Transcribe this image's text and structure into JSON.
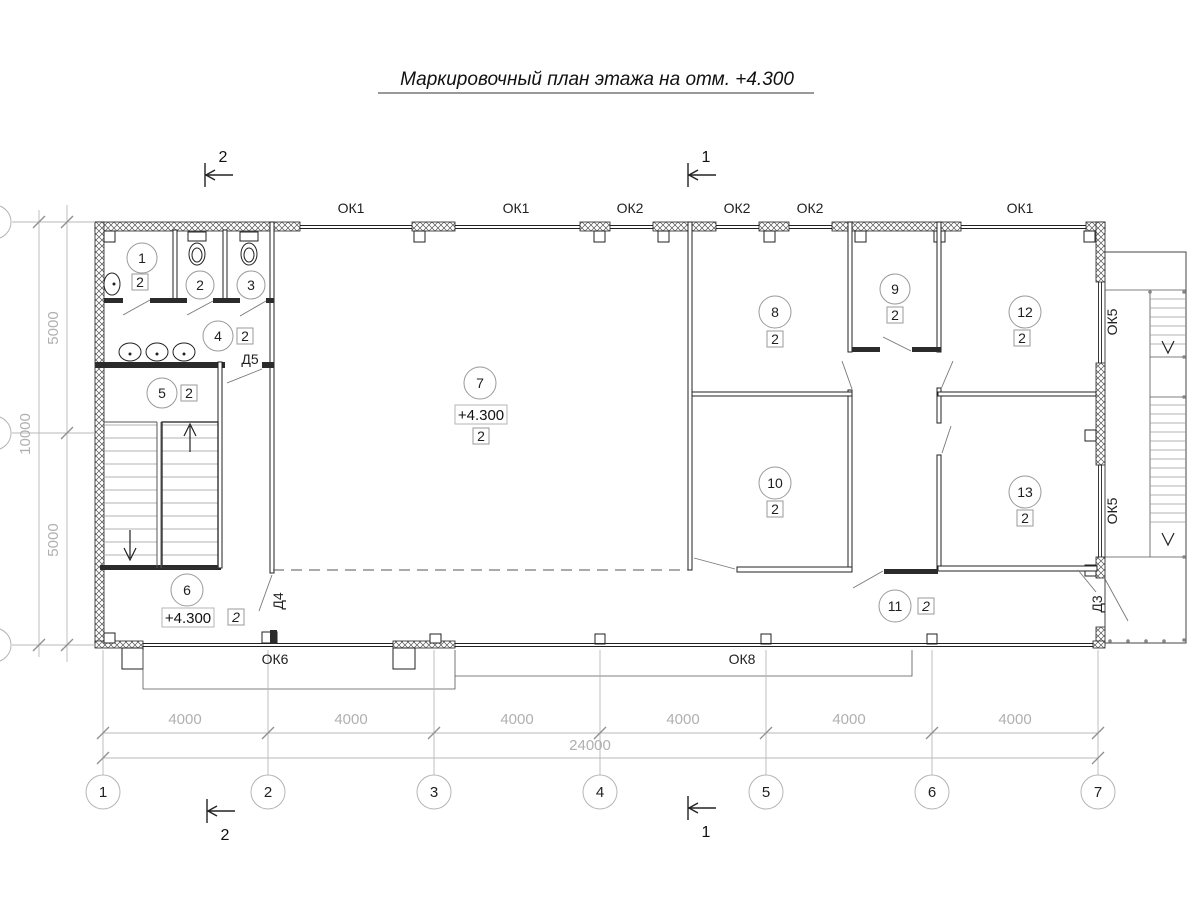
{
  "title": {
    "text": "Маркировочный план этажа на отм. +4.300"
  },
  "sections": {
    "top_left": "2",
    "top_center": "1",
    "bottom_left": "2",
    "bottom_center": "1"
  },
  "rooms": [
    {
      "number": "1",
      "qty": "2"
    },
    {
      "number": "2"
    },
    {
      "number": "3"
    },
    {
      "number": "4",
      "qty": "2"
    },
    {
      "number": "5",
      "qty": "2"
    },
    {
      "number": "6",
      "qty": "2",
      "elevation": "+4.300"
    },
    {
      "number": "7",
      "qty": "2",
      "elevation": "+4.300"
    },
    {
      "number": "8",
      "qty": "2"
    },
    {
      "number": "9",
      "qty": "2"
    },
    {
      "number": "10",
      "qty": "2"
    },
    {
      "number": "11",
      "qty": "2"
    },
    {
      "number": "12",
      "qty": "2"
    },
    {
      "number": "13",
      "qty": "2"
    }
  ],
  "windows": {
    "top": [
      "ОК1",
      "ОК1",
      "ОК2",
      "ОК2",
      "ОК2",
      "ОК1"
    ],
    "right": [
      "ОК5",
      "ОК5"
    ],
    "bottom": [
      "ОК6",
      "ОК8"
    ]
  },
  "doors": {
    "d5": "Д5",
    "d4": "Д4",
    "d3": "Д3"
  },
  "dimensions": {
    "spans": [
      "4000",
      "4000",
      "4000",
      "4000",
      "4000",
      "4000"
    ],
    "total": "24000",
    "left": [
      "5000",
      "10000",
      "5000"
    ]
  },
  "axes": [
    "1",
    "2",
    "3",
    "4",
    "5",
    "6",
    "7"
  ]
}
